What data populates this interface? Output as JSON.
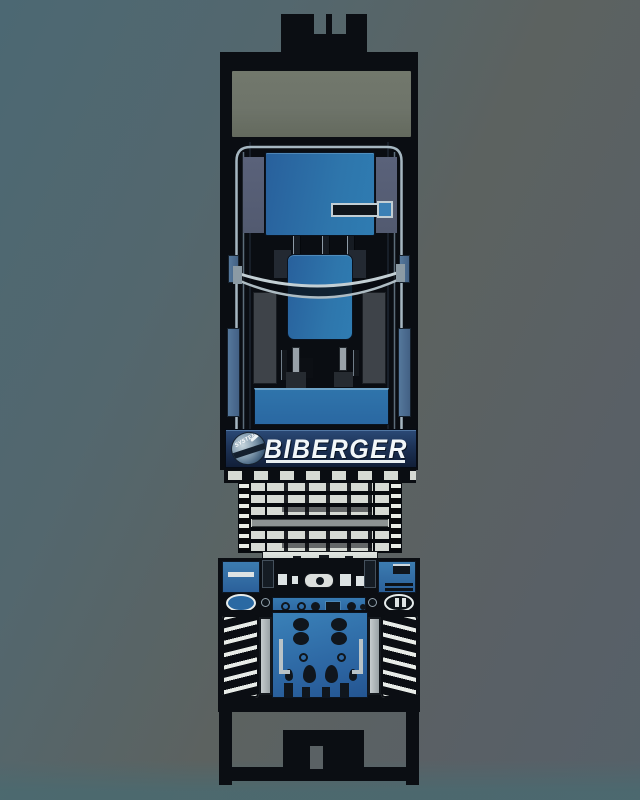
{
  "logo": {
    "brand": "BIBERGER",
    "badge_text": "SYSTEM"
  },
  "colors": {
    "background_teal": "#4c6873",
    "background_gray": "#5c6260",
    "background_bottom": "#4a666e",
    "machine_frame": "#0b0e13",
    "machine_interior": "#0a0d12",
    "panel_olive": "#6e746a",
    "panel_blue": "#2e76ac",
    "panel_blue_dark": "#28609c",
    "control_blue": "#3a81b8",
    "rail_silver": "#a6b7c1",
    "bow_silver": "#c3cfd4",
    "slat_silver": "#d6dad4",
    "silver_strip": "#c6ccc8",
    "spring_white": "#e8ece8",
    "slate_panel": "#525a70",
    "gray_block": "#3e4349",
    "knob_dark": "#10161d",
    "oval_ring": "#e6ecec",
    "logo_band_top": "#2b4a77",
    "logo_band_bottom": "#111f38",
    "logo_text": "#f2f7f9"
  }
}
